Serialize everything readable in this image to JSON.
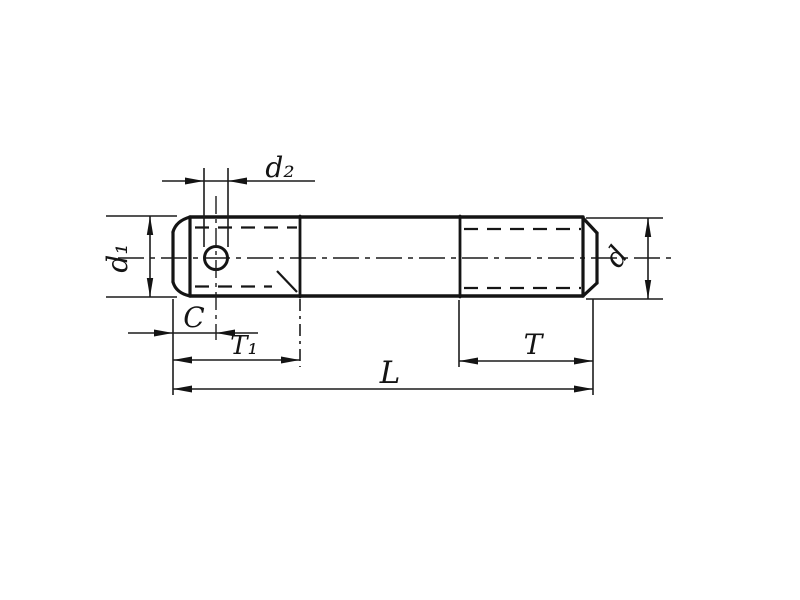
{
  "drawing": {
    "description": "Engineering dimension drawing of a double-ended stud with cotter pin hole",
    "ink_color": "#161616",
    "background_color": "#ffffff",
    "labels": {
      "d2": "d₂",
      "d1": "d₁",
      "d": "d",
      "c": "C",
      "t1": "T₁",
      "l": "L",
      "t": "T"
    }
  }
}
